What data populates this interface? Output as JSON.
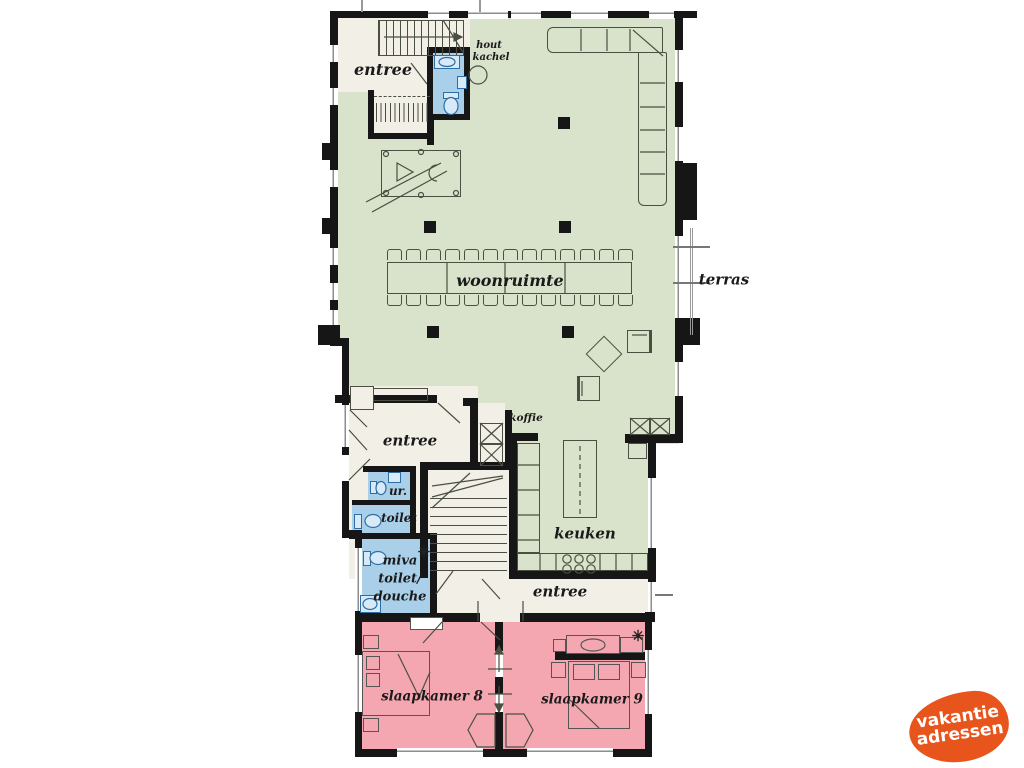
{
  "floorplan": {
    "labels": {
      "entree_top": "entree",
      "entree_mid": "entree",
      "entree_bottom": "entree",
      "woonruimte": "woonruimte",
      "keuken": "keuken",
      "koffie": "koffie",
      "terras": "terras",
      "urinal": "ur.",
      "toilet": "toilet",
      "miva_1": "miva",
      "miva_2": "toilet/",
      "miva_3": "douche",
      "hout_1": "hout",
      "hout_2": "kachel",
      "slaapkamer_8": "slaapkamer 8",
      "slaapkamer_9": "slaapkamer 9"
    },
    "symbols": {
      "shower": "✳"
    },
    "furniture": {
      "dining_chairs_per_side": 13
    }
  },
  "logo": {
    "line1": "vakantie",
    "line2": "adressen"
  },
  "palette": {
    "wall": "#161616",
    "green": "#d9e2cb",
    "cream": "#f2efe7",
    "blue": "#a9cfe9",
    "bluefill": "#d8eaf7",
    "bluestroke": "#2e6ea6",
    "pink": "#f5a7b1",
    "stroke": "#4a4f42",
    "winline": "#8d8d8d",
    "ink": "#1a1a1a",
    "brand": "#e8551c"
  }
}
